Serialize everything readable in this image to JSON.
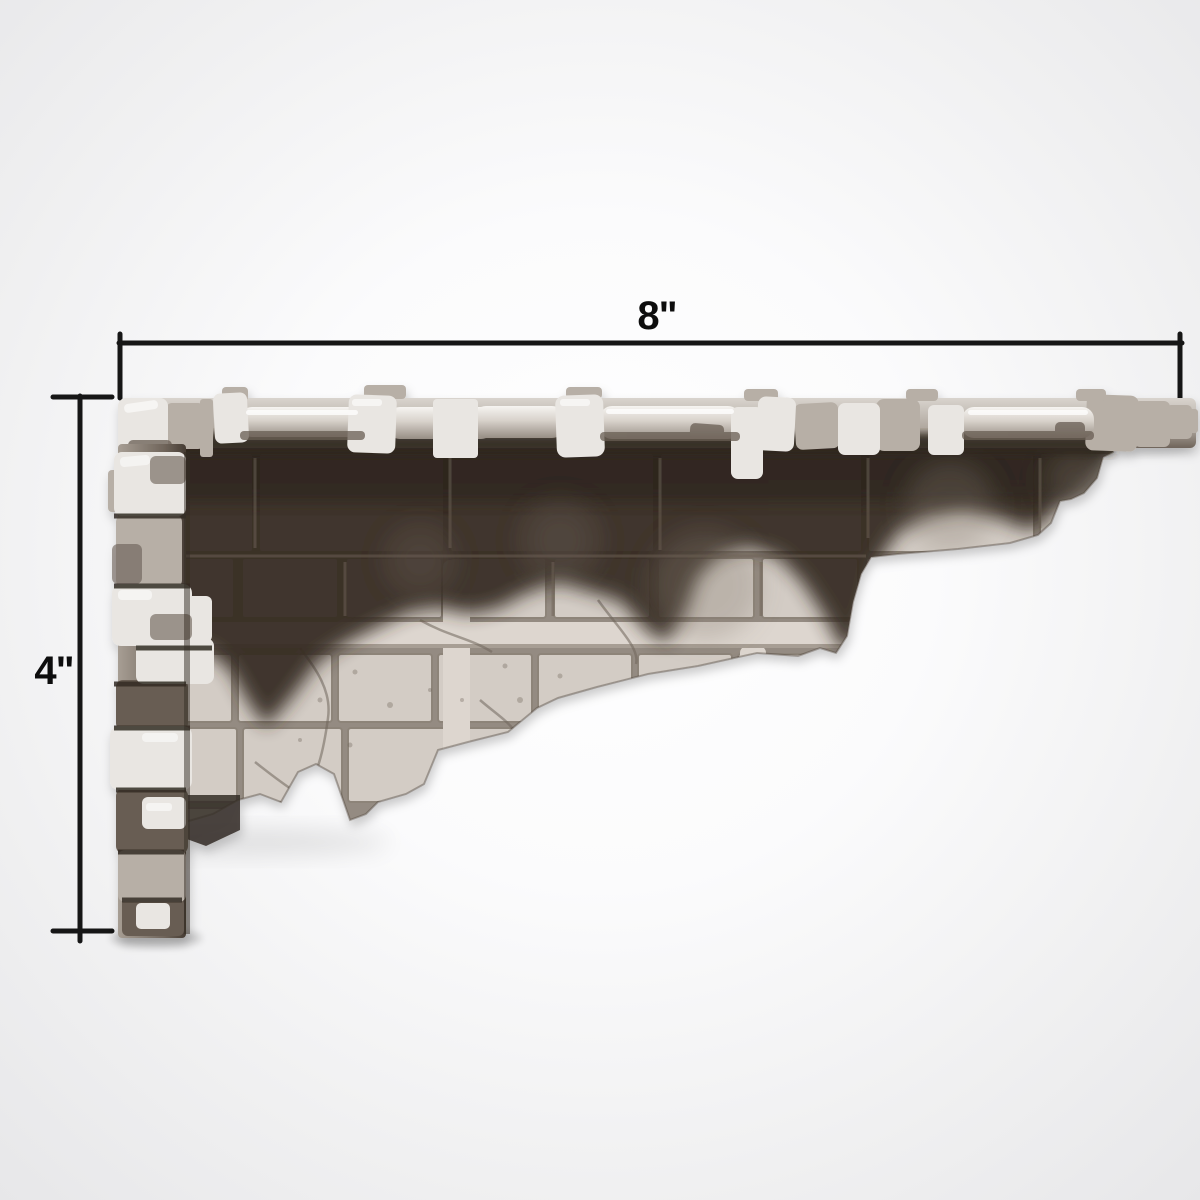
{
  "scene": {
    "subject": "ruined-stone-floor-terrain-tile-render",
    "background_center": "#ffffff",
    "background_edge": "#e7e7e9"
  },
  "dimensions": {
    "width_label": "8\"",
    "height_label": "4\"",
    "line_color": "#161616",
    "text_color": "#0d0d0d"
  },
  "model": {
    "colors": {
      "floor_lit": "#d3ccc5",
      "floor_shadow": "#342b23",
      "grout": "#948b82",
      "stone_light": "#e9e6e2",
      "stone_mid": "#b7afa6",
      "stone_dark": "#685d53",
      "crevice": "#332b24",
      "band_light": "#ddd6cf"
    }
  }
}
